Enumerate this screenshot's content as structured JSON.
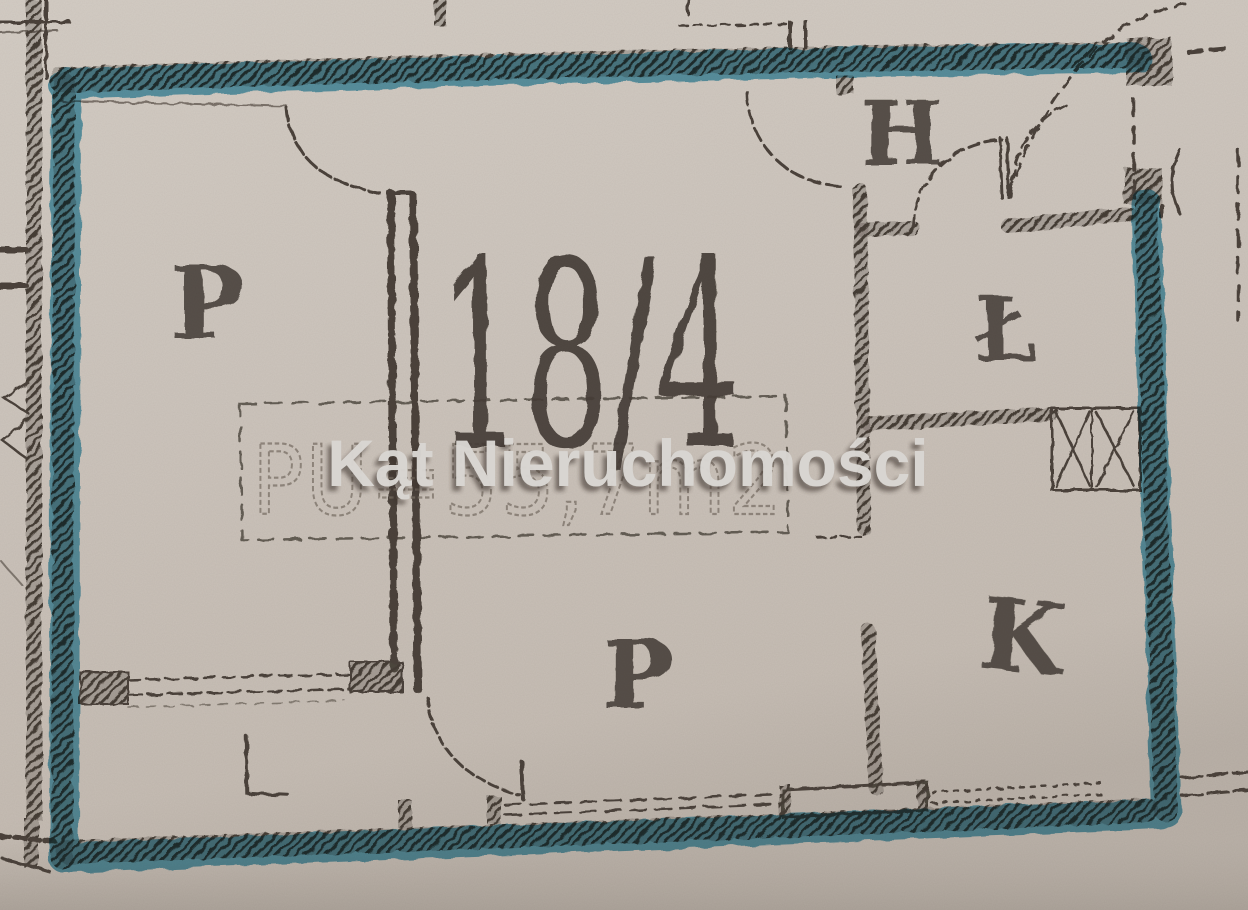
{
  "watermark": {
    "text": "Kąt Nieruchomości"
  },
  "plan": {
    "unit_number": "18/4",
    "area_text": "PU=55,7m2",
    "rooms": [
      {
        "id": "room-left",
        "label": "P"
      },
      {
        "id": "hall",
        "label": "H"
      },
      {
        "id": "bathroom",
        "label": "Ł"
      },
      {
        "id": "kitchen",
        "label": "K"
      },
      {
        "id": "room-bottom",
        "label": "P"
      },
      {
        "id": "loggia-mark",
        "label": "L"
      }
    ],
    "colors": {
      "paper": "#cfc7bf",
      "ink": "#4b433b",
      "highlight": "#4aa2c2",
      "watermark_fill": "#d9d6d2"
    }
  }
}
